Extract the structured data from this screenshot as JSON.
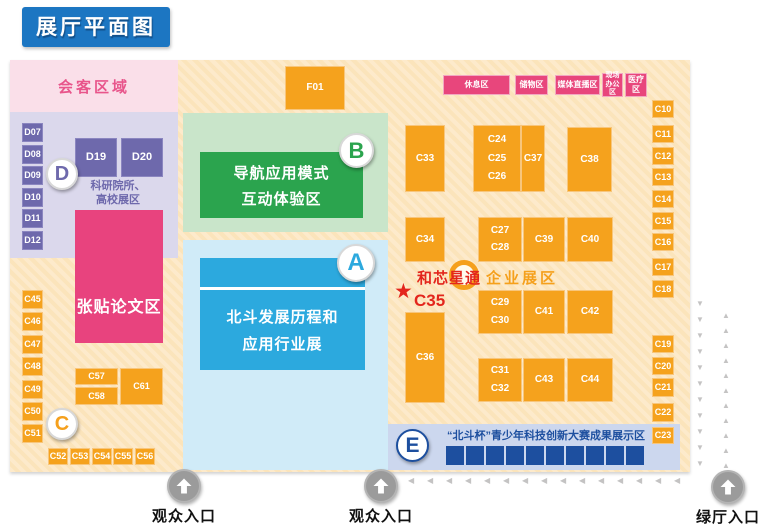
{
  "title": "展厅平面图",
  "colors": {
    "title_blue": "#1C76C2",
    "orange": "#F5A21D",
    "purple": "#6E69AC",
    "pink": "#E8467C",
    "green": "#2BA44E",
    "blue": "#2CA9DE",
    "navy": "#1D4F9F",
    "red": "#E3261D",
    "cream": "#FDEACB",
    "poster_pink": "#E8437E"
  },
  "zones": {
    "reception": {
      "label": "会客区域"
    },
    "research": {
      "badge": "D",
      "line1": "科研院所、",
      "line2": "高校展区"
    },
    "poster": {
      "label": "张贴论文区"
    },
    "b": {
      "badge": "B",
      "line1": "导航应用模式",
      "line2": "互动体验区"
    },
    "a": {
      "badge": "A",
      "line1": "北斗发展历程和",
      "line2": "应用行业展"
    },
    "c": {
      "badge": "C"
    },
    "enterprise": {
      "label": "企业展区"
    },
    "e": {
      "badge": "E",
      "label": "“北斗杯”青少年科技创新大赛成果展示区",
      "square_count": 10
    },
    "unicore": {
      "name": "和芯星通",
      "booth": "C35",
      "star": "★"
    }
  },
  "facilities": [
    {
      "label": "休息区",
      "x": 443,
      "y": 75,
      "w": 67,
      "h": 20
    },
    {
      "label": "储物区",
      "x": 515,
      "y": 75,
      "w": 33,
      "h": 20
    },
    {
      "label": "媒体直播区",
      "x": 555,
      "y": 75,
      "w": 45,
      "h": 20
    },
    {
      "label": "现场\n办公区",
      "x": 602,
      "y": 73,
      "w": 21,
      "h": 24,
      "fs": 7
    },
    {
      "label": "医疗区",
      "x": 625,
      "y": 73,
      "w": 22,
      "h": 24,
      "fs": 8
    }
  ],
  "booths": [
    {
      "labels": [
        "D07"
      ],
      "x": 22,
      "y": 123,
      "w": 21,
      "h": 19,
      "style": "purple"
    },
    {
      "labels": [
        "D08"
      ],
      "x": 22,
      "y": 145,
      "w": 21,
      "h": 19,
      "style": "purple"
    },
    {
      "labels": [
        "D09"
      ],
      "x": 22,
      "y": 166,
      "w": 21,
      "h": 19,
      "style": "purple"
    },
    {
      "labels": [
        "D10"
      ],
      "x": 22,
      "y": 188,
      "w": 21,
      "h": 19,
      "style": "purple"
    },
    {
      "labels": [
        "D11"
      ],
      "x": 22,
      "y": 209,
      "w": 21,
      "h": 19,
      "style": "purple"
    },
    {
      "labels": [
        "D12"
      ],
      "x": 22,
      "y": 231,
      "w": 21,
      "h": 19,
      "style": "purple"
    },
    {
      "labels": [
        "D19"
      ],
      "x": 75,
      "y": 138,
      "w": 42,
      "h": 39,
      "style": "purple",
      "fs": 11
    },
    {
      "labels": [
        "D20"
      ],
      "x": 121,
      "y": 138,
      "w": 42,
      "h": 39,
      "style": "purple",
      "fs": 11
    },
    {
      "labels": [
        "F01"
      ],
      "x": 285,
      "y": 66,
      "w": 60,
      "h": 44,
      "fs": 10
    },
    {
      "labels": [
        "C45"
      ],
      "x": 22,
      "y": 290,
      "w": 21,
      "h": 19
    },
    {
      "labels": [
        "C46"
      ],
      "x": 22,
      "y": 312,
      "w": 21,
      "h": 19
    },
    {
      "labels": [
        "C47"
      ],
      "x": 22,
      "y": 335,
      "w": 21,
      "h": 19
    },
    {
      "labels": [
        "C48"
      ],
      "x": 22,
      "y": 357,
      "w": 21,
      "h": 19
    },
    {
      "labels": [
        "C49"
      ],
      "x": 22,
      "y": 380,
      "w": 21,
      "h": 19
    },
    {
      "labels": [
        "C50"
      ],
      "x": 22,
      "y": 402,
      "w": 21,
      "h": 19
    },
    {
      "labels": [
        "C51"
      ],
      "x": 22,
      "y": 424,
      "w": 21,
      "h": 19
    },
    {
      "labels": [
        "C52"
      ],
      "x": 48,
      "y": 448,
      "w": 20,
      "h": 17
    },
    {
      "labels": [
        "C53"
      ],
      "x": 70,
      "y": 448,
      "w": 20,
      "h": 17
    },
    {
      "labels": [
        "C54"
      ],
      "x": 92,
      "y": 448,
      "w": 20,
      "h": 17
    },
    {
      "labels": [
        "C55"
      ],
      "x": 113,
      "y": 448,
      "w": 20,
      "h": 17
    },
    {
      "labels": [
        "C56"
      ],
      "x": 135,
      "y": 448,
      "w": 20,
      "h": 17
    },
    {
      "labels": [
        "C57"
      ],
      "x": 75,
      "y": 368,
      "w": 43,
      "h": 17
    },
    {
      "labels": [
        "C58"
      ],
      "x": 75,
      "y": 387,
      "w": 43,
      "h": 18
    },
    {
      "labels": [
        "C61"
      ],
      "x": 120,
      "y": 368,
      "w": 43,
      "h": 37
    },
    {
      "labels": [
        "C33"
      ],
      "x": 405,
      "y": 125,
      "w": 40,
      "h": 67,
      "fs": 10
    },
    {
      "labels": [
        "C24",
        "C25",
        "C26"
      ],
      "x": 473,
      "y": 125,
      "w": 48,
      "h": 67,
      "fs": 10
    },
    {
      "labels": [
        "C37"
      ],
      "x": 521,
      "y": 125,
      "w": 24,
      "h": 67,
      "fs": 10
    },
    {
      "labels": [
        "C38"
      ],
      "x": 567,
      "y": 127,
      "w": 45,
      "h": 65,
      "fs": 10
    },
    {
      "labels": [
        "C34"
      ],
      "x": 405,
      "y": 217,
      "w": 40,
      "h": 45,
      "fs": 10
    },
    {
      "labels": [
        "C27",
        "C28"
      ],
      "x": 478,
      "y": 217,
      "w": 44,
      "h": 45,
      "fs": 10
    },
    {
      "labels": [
        "C39"
      ],
      "x": 523,
      "y": 217,
      "w": 42,
      "h": 45,
      "fs": 10
    },
    {
      "labels": [
        "C40"
      ],
      "x": 567,
      "y": 217,
      "w": 46,
      "h": 45,
      "fs": 10
    },
    {
      "labels": [
        "C29",
        "C30"
      ],
      "x": 478,
      "y": 290,
      "w": 44,
      "h": 44,
      "fs": 10
    },
    {
      "labels": [
        "C41"
      ],
      "x": 523,
      "y": 290,
      "w": 42,
      "h": 44,
      "fs": 10
    },
    {
      "labels": [
        "C42"
      ],
      "x": 567,
      "y": 290,
      "w": 46,
      "h": 44,
      "fs": 10
    },
    {
      "labels": [
        "C36"
      ],
      "x": 405,
      "y": 312,
      "w": 40,
      "h": 91,
      "fs": 10
    },
    {
      "labels": [
        "C31",
        "C32"
      ],
      "x": 478,
      "y": 358,
      "w": 44,
      "h": 44,
      "fs": 10
    },
    {
      "labels": [
        "C43"
      ],
      "x": 523,
      "y": 358,
      "w": 42,
      "h": 44,
      "fs": 10
    },
    {
      "labels": [
        "C44"
      ],
      "x": 567,
      "y": 358,
      "w": 46,
      "h": 44,
      "fs": 10
    },
    {
      "labels": [
        "C10"
      ],
      "x": 652,
      "y": 100,
      "w": 22,
      "h": 18
    },
    {
      "labels": [
        "C11"
      ],
      "x": 652,
      "y": 125,
      "w": 22,
      "h": 18
    },
    {
      "labels": [
        "C12"
      ],
      "x": 652,
      "y": 147,
      "w": 22,
      "h": 18
    },
    {
      "labels": [
        "C13"
      ],
      "x": 652,
      "y": 168,
      "w": 22,
      "h": 18
    },
    {
      "labels": [
        "C14"
      ],
      "x": 652,
      "y": 190,
      "w": 22,
      "h": 18
    },
    {
      "labels": [
        "C15"
      ],
      "x": 652,
      "y": 212,
      "w": 22,
      "h": 18
    },
    {
      "labels": [
        "C16"
      ],
      "x": 652,
      "y": 233,
      "w": 22,
      "h": 18
    },
    {
      "labels": [
        "C17"
      ],
      "x": 652,
      "y": 258,
      "w": 22,
      "h": 18
    },
    {
      "labels": [
        "C18"
      ],
      "x": 652,
      "y": 280,
      "w": 22,
      "h": 18
    },
    {
      "labels": [
        "C19"
      ],
      "x": 652,
      "y": 335,
      "w": 22,
      "h": 18
    },
    {
      "labels": [
        "C20"
      ],
      "x": 652,
      "y": 357,
      "w": 22,
      "h": 18
    },
    {
      "labels": [
        "C21"
      ],
      "x": 652,
      "y": 378,
      "w": 22,
      "h": 19
    },
    {
      "labels": [
        "C22"
      ],
      "x": 652,
      "y": 403,
      "w": 22,
      "h": 19
    },
    {
      "labels": [
        "C23"
      ],
      "x": 652,
      "y": 427,
      "w": 22,
      "h": 17
    }
  ],
  "entrances": [
    {
      "label": "观众入口",
      "cx": 184,
      "cy": 486
    },
    {
      "label": "观众入口",
      "cx": 381,
      "cy": 486
    },
    {
      "label": "绿厅入口",
      "cx": 728,
      "cy": 487
    }
  ],
  "glyphs": {
    "trail_left": "◀",
    "trail_up": "▲",
    "trail_down": "▼",
    "entrance_arrow": "up-arrow"
  }
}
